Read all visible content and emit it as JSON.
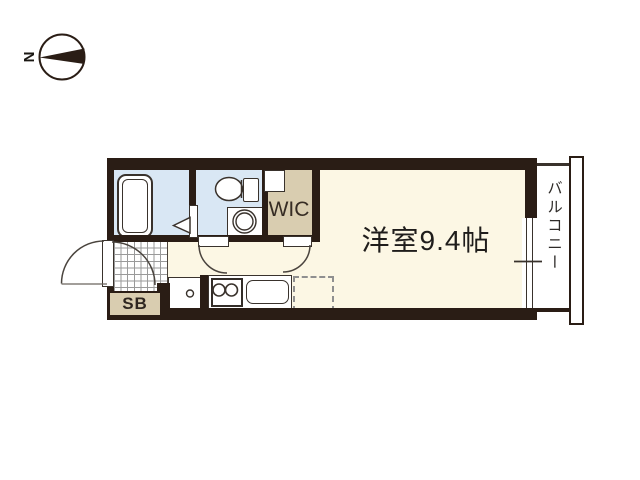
{
  "compass": {
    "north_label": "N"
  },
  "rooms": {
    "main_room": {
      "label": "洋室9.4帖"
    },
    "walk_in_closet": {
      "label": "WIC"
    },
    "balcony": {
      "label": "バルコニー"
    },
    "shoe_box": {
      "label": "SB"
    }
  },
  "fixtures": {
    "bathtub": "bathtub-icon",
    "toilet": "toilet-icon",
    "washing_machine_pan": "washing-machine-pan-icon",
    "stove": "two-burner-stove-icon",
    "kitchen_sink": "kitchen-sink-icon",
    "refrigerator_space": "refrigerator-space-outline",
    "entrance_door": "entrance-door-swing",
    "bathroom_door": "folding-door-triangle",
    "sliding_window": "sliding-window",
    "balcony_railing": "railing"
  },
  "colors": {
    "wall": "#2a1d15",
    "wet": "#d9e7f4",
    "closet": "#d9cdb0",
    "floor": "#fcf7e4",
    "outline": "#39322c",
    "text": "#1f1d1b",
    "grid": "#9a9a9a"
  }
}
